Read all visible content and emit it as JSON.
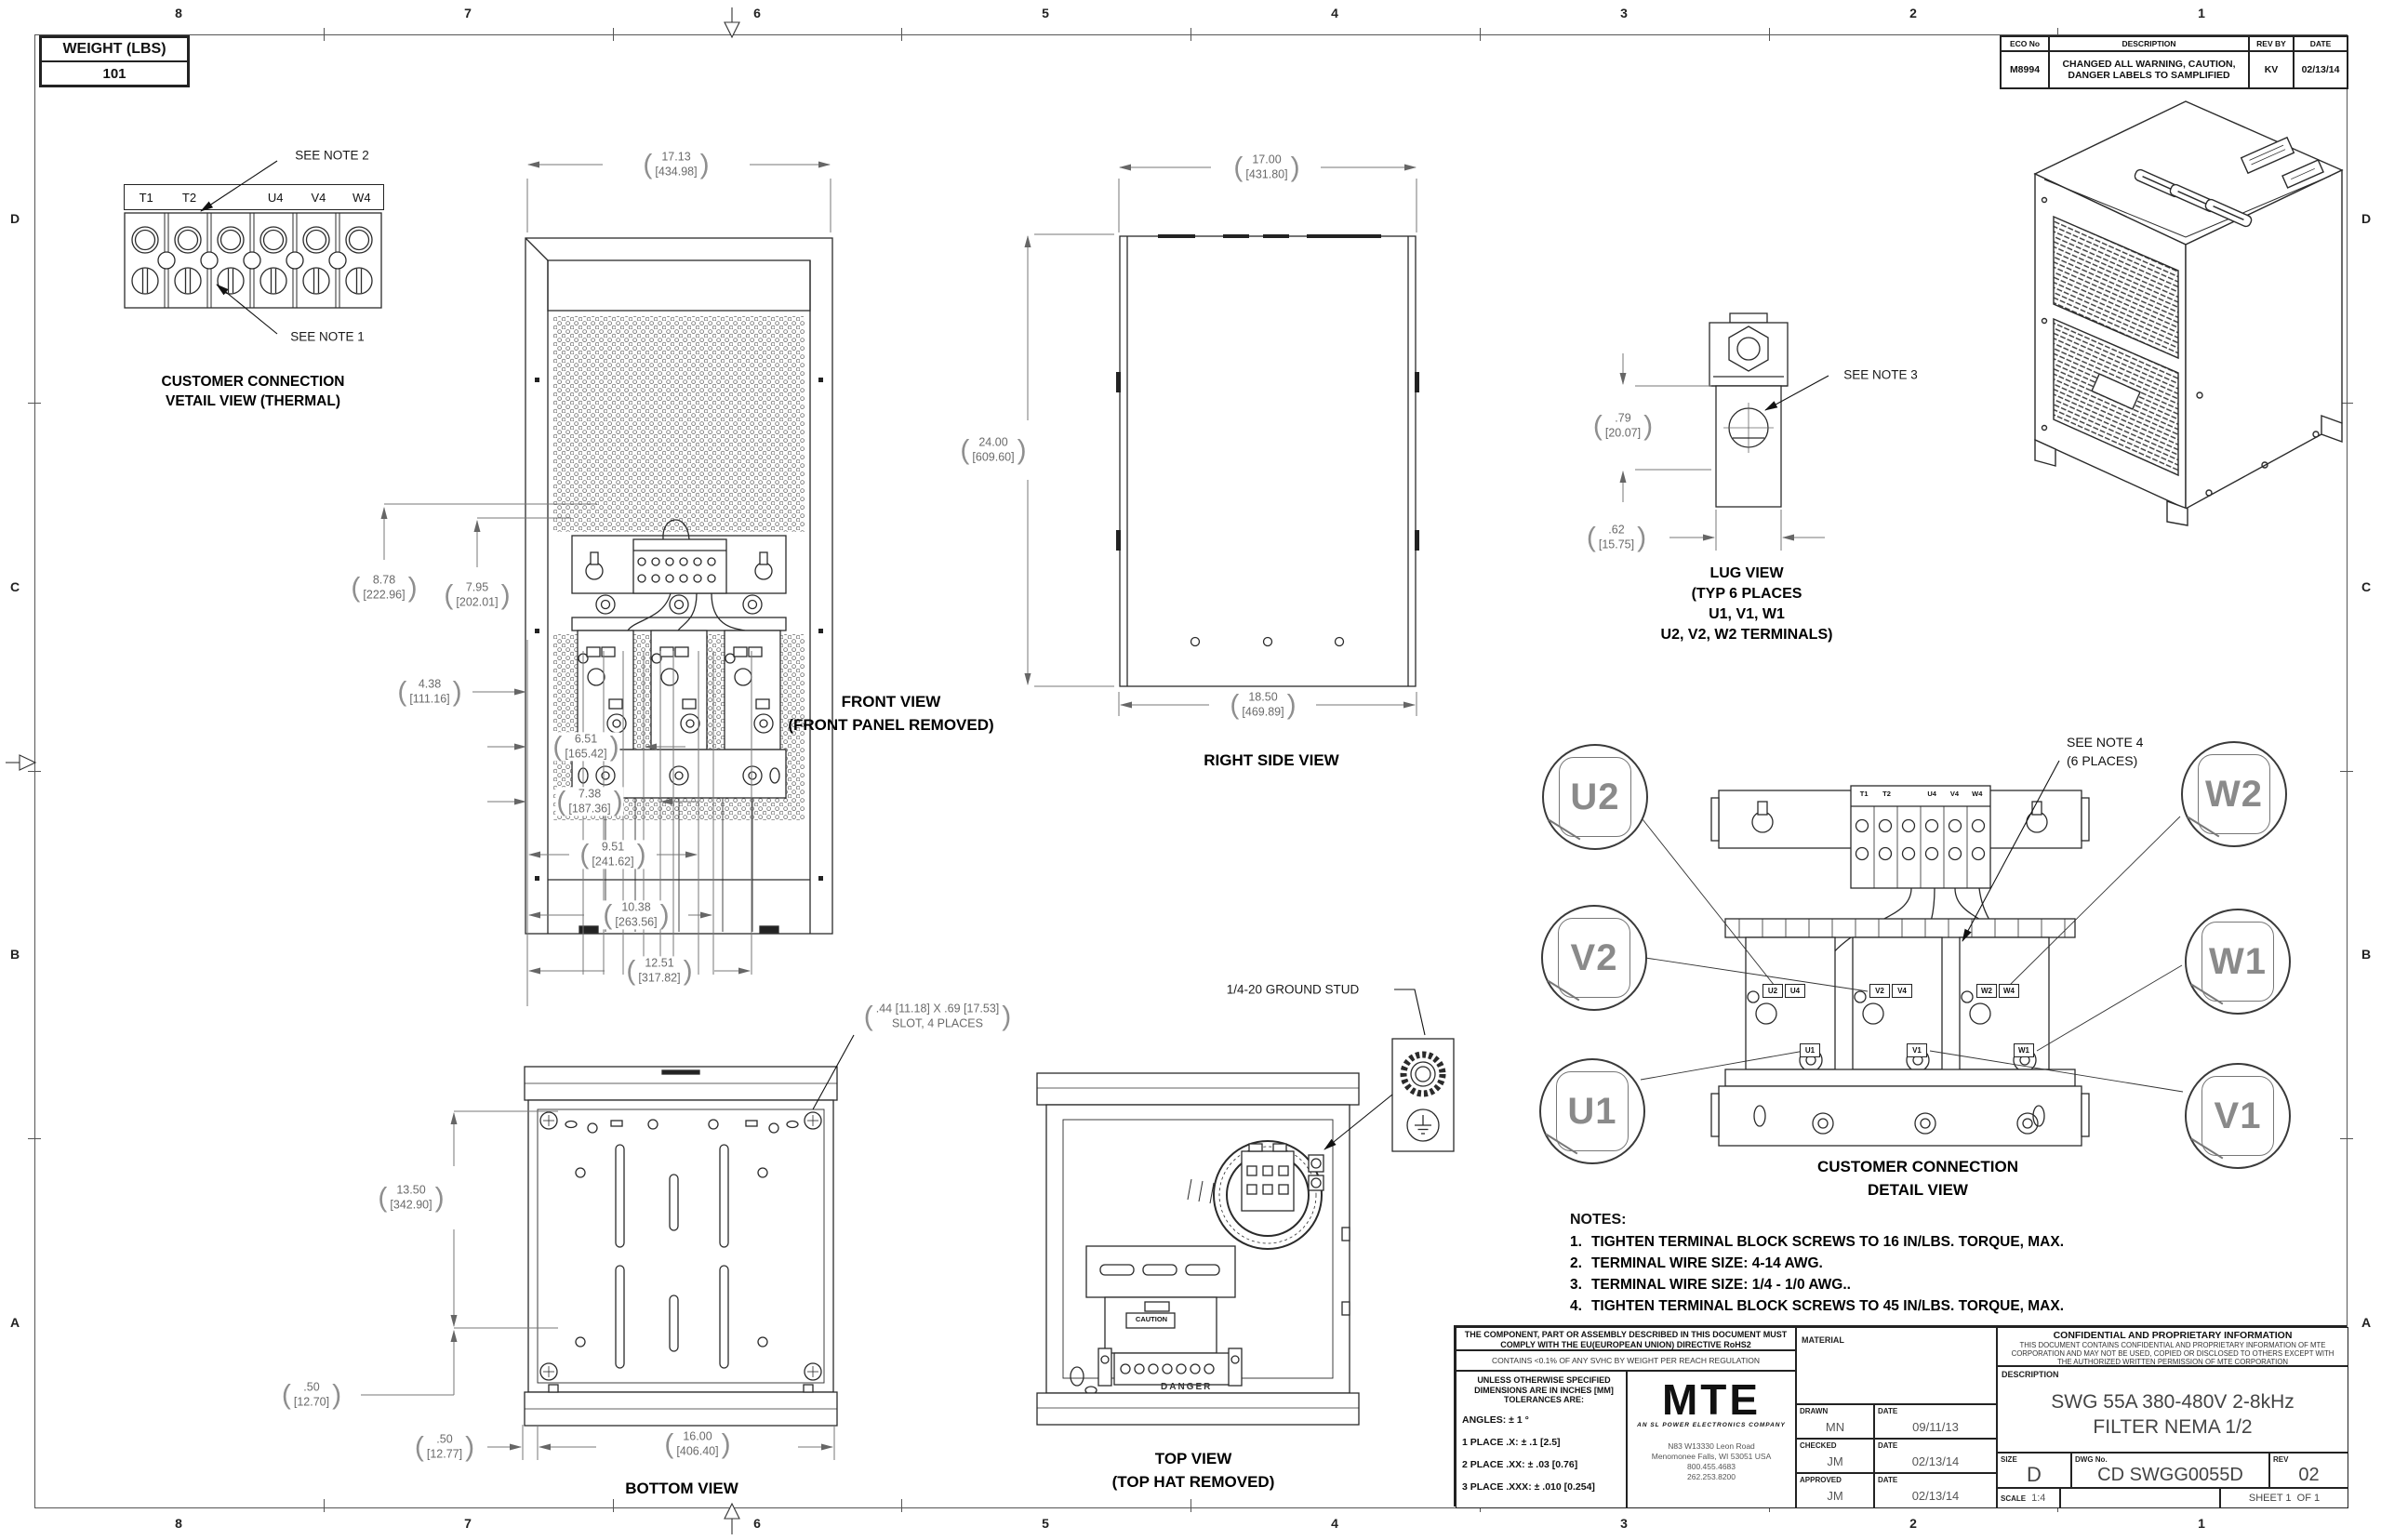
{
  "border": {
    "cols": [
      "8",
      "7",
      "6",
      "5",
      "4",
      "3",
      "2",
      "1"
    ],
    "rows": [
      "D",
      "C",
      "B",
      "A"
    ]
  },
  "weight_table": {
    "title": "WEIGHT (LBS)",
    "value": "101"
  },
  "eco_table": {
    "h_eco": "ECO No",
    "h_desc": "DESCRIPTION",
    "h_rev": "REV BY",
    "h_date": "DATE",
    "row": {
      "eco_no": "M8994",
      "description": "CHANGED ALL WARNING, CAUTION, DANGER LABELS TO SAMPLIFIED",
      "rev_by": "KV",
      "date": "02/13/14"
    }
  },
  "thermal_view": {
    "labels": [
      "T1",
      "T2",
      "",
      "U4",
      "V4",
      "W4"
    ],
    "note2": "SEE NOTE 2",
    "note1": "SEE NOTE 1",
    "caption1": "CUSTOMER CONNECTION",
    "caption2": "VETAIL VIEW (THERMAL)"
  },
  "front_view": {
    "caption1": "FRONT VIEW",
    "caption2": "(FRONT PANEL REMOVED)"
  },
  "right_view": {
    "caption": "RIGHT SIDE VIEW"
  },
  "lug_view": {
    "note3": "SEE NOTE 3",
    "caption1": "LUG VIEW",
    "caption2": "(TYP 6 PLACES",
    "caption3": "U1, V1, W1",
    "caption4": "U2, V2, W2 TERMINALS)"
  },
  "top_view": {
    "ground_stud": "1/4-20 GROUND STUD",
    "caption1": "TOP VIEW",
    "caption2": "(TOP HAT REMOVED)",
    "caution": "CAUTION",
    "danger": "DANGER"
  },
  "bottom_view": {
    "caption": "BOTTOM VIEW",
    "slot_note1": ".44 [11.18]  X .69 [17.53]",
    "slot_note2": "SLOT, 4 PLACES"
  },
  "connection_view": {
    "note4_1": "SEE NOTE 4",
    "note4_2": "(6 PLACES)",
    "caption1": "CUSTOMER CONNECTION",
    "caption2": "DETAIL VIEW",
    "callouts": [
      "U2",
      "V2",
      "U1",
      "W2",
      "W1",
      "V1"
    ],
    "strip_labels": [
      "T1",
      "T2",
      "",
      "U4",
      "V4",
      "W4"
    ],
    "tags": {
      "u2": "U2",
      "u4": "U4",
      "v2": "V2",
      "v4": "V4",
      "w2": "W2",
      "w4": "W4",
      "u1": "U1",
      "v1": "V1",
      "w1": "W1"
    }
  },
  "dims": {
    "front_width": {
      "in": "17.13",
      "mm": "[434.98]"
    },
    "front_h1": {
      "in": "8.78",
      "mm": "[222.96]"
    },
    "front_h2": {
      "in": "7.95",
      "mm": "[202.01]"
    },
    "front_438": {
      "in": "4.38",
      "mm": "[111.16]"
    },
    "front_651": {
      "in": "6.51",
      "mm": "[165.42]"
    },
    "front_738": {
      "in": "7.38",
      "mm": "[187.36]"
    },
    "front_951": {
      "in": "9.51",
      "mm": "[241.62]"
    },
    "front_1038": {
      "in": "10.38",
      "mm": "[263.56]"
    },
    "front_1251": {
      "in": "12.51",
      "mm": "[317.82]"
    },
    "side_width": {
      "in": "17.00",
      "mm": "[431.80]"
    },
    "side_height": {
      "in": "24.00",
      "mm": "[609.60]"
    },
    "side_depth": {
      "in": "18.50",
      "mm": "[469.89]"
    },
    "lug_79": {
      "in": ".79",
      "mm": "[20.07]"
    },
    "lug_62": {
      "in": ".62",
      "mm": "[15.75]"
    },
    "bottom_1350": {
      "in": "13.50",
      "mm": "[342.90]"
    },
    "bottom_50a": {
      "in": ".50",
      "mm": "[12.70]"
    },
    "bottom_50b": {
      "in": ".50",
      "mm": "[12.77]"
    },
    "bottom_1600": {
      "in": "16.00",
      "mm": "[406.40]"
    }
  },
  "notes": {
    "title": "NOTES:",
    "items": [
      {
        "num": "1.",
        "text": "TIGHTEN TERMINAL BLOCK SCREWS TO 16 IN/LBS. TORQUE, MAX."
      },
      {
        "num": "2.",
        "text": "TERMINAL WIRE SIZE: 4-14 AWG."
      },
      {
        "num": "3.",
        "text": "TERMINAL WIRE SIZE: 1/4 - 1/0 AWG.."
      },
      {
        "num": "4.",
        "text": "TIGHTEN TERMINAL BLOCK SCREWS TO 45 IN/LBS. TORQUE, MAX."
      }
    ]
  },
  "title_block": {
    "compliance": "THE COMPONENT, PART OR ASSEMBLY DESCRIBED IN THIS DOCUMENT MUST COMPLY WITH THE EU(EUROPEAN UNION) DIRECTIVE RoHS2",
    "reach": "CONTAINS <0.1% OF ANY SVHC BY WEIGHT PER REACH REGULATION",
    "tol_h1": "UNLESS OTHERWISE SPECIFIED",
    "tol_h2": "DIMENSIONS ARE IN INCHES [MM]",
    "tol_h3": "TOLERANCES ARE:",
    "tol_angles": "ANGLES: ± 1 °",
    "tol_1": "1 PLACE .X: ± .1 [2.5]",
    "tol_2": "2 PLACE .XX: ± .03 [0.76]",
    "tol_3": "3 PLACE .XXX: ± .010 [0.254]",
    "logo": "MTE",
    "logo_tag": "AN SL POWER ELECTRONICS COMPANY",
    "addr1": "N83 W13330 Leon Road",
    "addr2": "Menomonee Falls, WI 53051 USA",
    "addr3": "800.455.4683",
    "addr4": "262.253.8200",
    "material_label": "MATERIAL",
    "drawn_label": "DRAWN",
    "drawn_name": "MN",
    "drawn_date_label": "DATE",
    "drawn_date": "09/11/13",
    "checked_label": "CHECKED",
    "checked_name": "JM",
    "checked_date_label": "DATE",
    "checked_date": "02/13/14",
    "approved_label": "APPROVED",
    "approved_name": "JM",
    "approved_date_label": "DATE",
    "approved_date": "02/13/14",
    "conf_title": "CONFIDENTIAL AND PROPRIETARY INFORMATION",
    "conf_body": "THIS DOCUMENT CONTAINS CONFIDENTIAL AND PROPRIETARY INFORMATION OF MTE CORPORATION AND MAY NOT BE USED, COPIED OR DISCLOSED TO OTHERS EXCEPT WITH THE AUTHORIZED WRITTEN PERMISSION OF MTE CORPORATION",
    "desc_label": "DESCRIPTION",
    "desc1": "SWG 55A 380-480V 2-8kHz",
    "desc2": "FILTER NEMA 1/2",
    "size_label": "SIZE",
    "size": "D",
    "dwg_label": "DWG No.",
    "dwg": "CD SWGG0055D",
    "rev_label": "REV",
    "rev": "02",
    "scale_label": "SCALE",
    "scale": "1:4",
    "sheet": "SHEET 1  OF 1"
  }
}
